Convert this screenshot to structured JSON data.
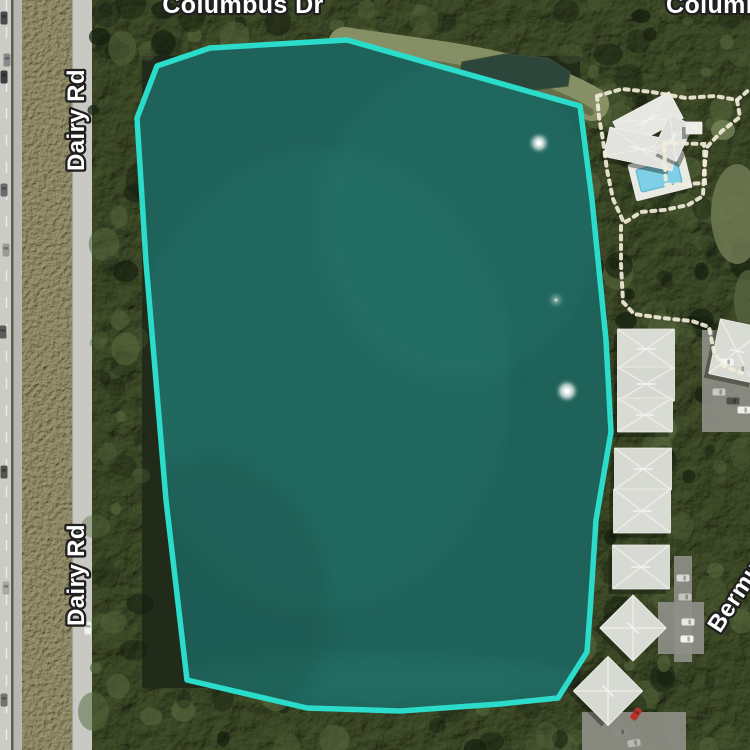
{
  "app": {
    "type": "satellite-map-view"
  },
  "road_labels": [
    {
      "id": "road-label-columbus-top",
      "text": "Columbus Dr",
      "x": 243,
      "y": 13,
      "rotate": 0,
      "anchor": "middle",
      "size": 25
    },
    {
      "id": "road-label-columbus-top-right",
      "text": "Columbus Dr",
      "x": 666,
      "y": 13,
      "rotate": 0,
      "anchor": "start",
      "size": 25
    },
    {
      "id": "road-label-dairy-upper",
      "text": "Dairy Rd",
      "x": 84,
      "y": 120,
      "rotate": -90,
      "anchor": "middle",
      "size": 24
    },
    {
      "id": "road-label-dairy-lower",
      "text": "Dairy Rd",
      "x": 84,
      "y": 575,
      "rotate": -90,
      "anchor": "middle",
      "size": 24
    },
    {
      "id": "road-label-bermuda",
      "text": "Bermuda",
      "x": 720,
      "y": 634,
      "rotate": -57,
      "anchor": "start",
      "size": 24
    }
  ],
  "parcel": {
    "name": "highlighted-lake-parcel",
    "stroke": "#2CDCCB",
    "stroke_width": 5.5,
    "fill": "#1F625A",
    "points": [
      [
        157,
        66
      ],
      [
        210,
        48
      ],
      [
        347,
        40
      ],
      [
        580,
        106
      ],
      [
        592,
        200
      ],
      [
        606,
        340
      ],
      [
        611,
        432
      ],
      [
        596,
        520
      ],
      [
        590,
        612
      ],
      [
        587,
        652
      ],
      [
        558,
        698
      ],
      [
        500,
        704
      ],
      [
        400,
        711
      ],
      [
        307,
        708
      ],
      [
        187,
        680
      ],
      [
        166,
        500
      ],
      [
        146,
        262
      ],
      [
        137,
        118
      ]
    ]
  },
  "fountains": [
    {
      "x": 539,
      "y": 143,
      "r": 7,
      "opacity": 0.85
    },
    {
      "x": 567,
      "y": 391,
      "r": 8,
      "opacity": 0.85
    },
    {
      "x": 556,
      "y": 300,
      "r": 5,
      "opacity": 0.4
    }
  ],
  "pool_deck": {
    "cx": 660,
    "cy": 176,
    "w": 58,
    "h": 38,
    "rot": -14,
    "fill": "#E9EAE4"
  },
  "pool": {
    "cx": 659,
    "cy": 176,
    "w": 42,
    "h": 23,
    "rot": -14,
    "fill": "#7FD0E6"
  },
  "buildings": [
    {
      "cx": 648,
      "cy": 120,
      "w": 64,
      "h": 30,
      "rot": -28,
      "roof": "#E6E7E3"
    },
    {
      "cx": 641,
      "cy": 149,
      "w": 70,
      "h": 30,
      "rot": 12,
      "roof": "#E2E3DF"
    },
    {
      "cx": 673,
      "cy": 138,
      "w": 40,
      "h": 26,
      "rot": -65,
      "roof": "#DFE0DC"
    },
    {
      "cx": 694,
      "cy": 128,
      "w": 16,
      "h": 12,
      "rot": 0,
      "roof": "#EDEEE9"
    },
    {
      "cx": 737,
      "cy": 351,
      "w": 46,
      "h": 56,
      "rot": 12,
      "roof": "#D9DBD5"
    },
    {
      "cx": 646,
      "cy": 349,
      "w": 57,
      "h": 40,
      "rot": 0,
      "roof": "#D9DBD5"
    },
    {
      "cx": 646,
      "cy": 384,
      "w": 57,
      "h": 34,
      "rot": 0,
      "roof": "#D5D7D1"
    },
    {
      "cx": 645,
      "cy": 415,
      "w": 55,
      "h": 34,
      "rot": 0,
      "roof": "#D9DBD5"
    },
    {
      "cx": 643,
      "cy": 469,
      "w": 57,
      "h": 42,
      "rot": 0,
      "roof": "#D7D9D3"
    },
    {
      "cx": 642,
      "cy": 511,
      "w": 57,
      "h": 44,
      "rot": 0,
      "roof": "#D9DBD5"
    },
    {
      "cx": 641,
      "cy": 567,
      "w": 57,
      "h": 44,
      "rot": 0,
      "roof": "#D7D9D3"
    },
    {
      "cx": 633,
      "cy": 628,
      "w": 47,
      "h": 47,
      "rot": 45,
      "roof": "#D9DBD5"
    },
    {
      "cx": 608,
      "cy": 691,
      "w": 49,
      "h": 49,
      "rot": 45,
      "roof": "#D7D9D3"
    }
  ],
  "cars": [
    {
      "x": 4,
      "y": 18,
      "rot": 0,
      "c": "#4A4A4A"
    },
    {
      "x": 7,
      "y": 60,
      "rot": 0,
      "c": "#8A8A8A"
    },
    {
      "x": 4,
      "y": 77,
      "rot": 0,
      "c": "#3D3D3D"
    },
    {
      "x": 4,
      "y": 190,
      "rot": 0,
      "c": "#6B6B6B"
    },
    {
      "x": 6,
      "y": 250,
      "rot": 0,
      "c": "#9A9A96"
    },
    {
      "x": 3,
      "y": 332,
      "rot": 0,
      "c": "#5C5C58"
    },
    {
      "x": 4,
      "y": 472,
      "rot": 0,
      "c": "#55554F"
    },
    {
      "x": 6,
      "y": 588,
      "rot": 0,
      "c": "#A9A9A3"
    },
    {
      "x": 4,
      "y": 700,
      "rot": 0,
      "c": "#74746E"
    },
    {
      "x": 88,
      "y": 628,
      "rot": 0,
      "c": "#F2F2EE"
    },
    {
      "x": 727,
      "y": 362,
      "rot": 90,
      "c": "#F5F5F1"
    },
    {
      "x": 741,
      "y": 369,
      "rot": 90,
      "c": "#D8D8D2"
    },
    {
      "x": 719,
      "y": 392,
      "rot": 90,
      "c": "#C9C9C3"
    },
    {
      "x": 733,
      "y": 401,
      "rot": 90,
      "c": "#4F4F4B"
    },
    {
      "x": 744,
      "y": 410,
      "rot": 90,
      "c": "#EFEFEB"
    },
    {
      "x": 683,
      "y": 578,
      "rot": 90,
      "c": "#D9D9D3"
    },
    {
      "x": 685,
      "y": 597,
      "rot": 90,
      "c": "#C4C4BE"
    },
    {
      "x": 688,
      "y": 622,
      "rot": 90,
      "c": "#E8E8E2"
    },
    {
      "x": 687,
      "y": 639,
      "rot": 90,
      "c": "#F4F4F0"
    },
    {
      "x": 636,
      "y": 714,
      "rot": 35,
      "c": "#B8342A"
    },
    {
      "x": 621,
      "y": 732,
      "rot": 80,
      "c": "#8D8D87"
    },
    {
      "x": 634,
      "y": 743,
      "rot": 80,
      "c": "#B9B9B3"
    }
  ],
  "pavements": [
    {
      "x": 702,
      "y": 330,
      "w": 48,
      "h": 102
    },
    {
      "x": 674,
      "y": 556,
      "w": 18,
      "h": 106
    },
    {
      "x": 658,
      "y": 602,
      "w": 46,
      "h": 52
    },
    {
      "x": 582,
      "y": 712,
      "w": 104,
      "h": 38
    }
  ],
  "dotted_paths": {
    "clubhouse_loop": [
      [
        597,
        96
      ],
      [
        622,
        89
      ],
      [
        652,
        92
      ],
      [
        686,
        98
      ],
      [
        715,
        96
      ],
      [
        737,
        100
      ],
      [
        740,
        117
      ],
      [
        722,
        131
      ],
      [
        707,
        147
      ],
      [
        704,
        172
      ],
      [
        703,
        196
      ],
      [
        688,
        205
      ],
      [
        664,
        210
      ],
      [
        641,
        212
      ],
      [
        624,
        223
      ],
      [
        613,
        199
      ],
      [
        607,
        170
      ],
      [
        603,
        140
      ],
      [
        599,
        117
      ],
      [
        597,
        96
      ]
    ],
    "pool_enclosure": [
      [
        664,
        143
      ],
      [
        704,
        144
      ],
      [
        705,
        183
      ],
      [
        666,
        185
      ],
      [
        664,
        143
      ]
    ],
    "south_path": [
      [
        621,
        226
      ],
      [
        621,
        264
      ],
      [
        623,
        302
      ],
      [
        634,
        314
      ],
      [
        662,
        318
      ],
      [
        692,
        321
      ],
      [
        709,
        327
      ],
      [
        714,
        352
      ],
      [
        723,
        366
      ],
      [
        742,
        373
      ]
    ],
    "northeast_spur": [
      [
        737,
        100
      ],
      [
        750,
        89
      ]
    ]
  },
  "palette": {
    "parcel_stroke": "#2CDCCB",
    "parcel_fill": "#1F625A",
    "pond_water": "#2C463C",
    "road": "#C9C9C3",
    "roof": "#D8DAD4",
    "pool": "#7FD0E6",
    "path_dots": "#F2ECD9",
    "label_text": "#FFFFFF",
    "label_outline": "#202020"
  }
}
